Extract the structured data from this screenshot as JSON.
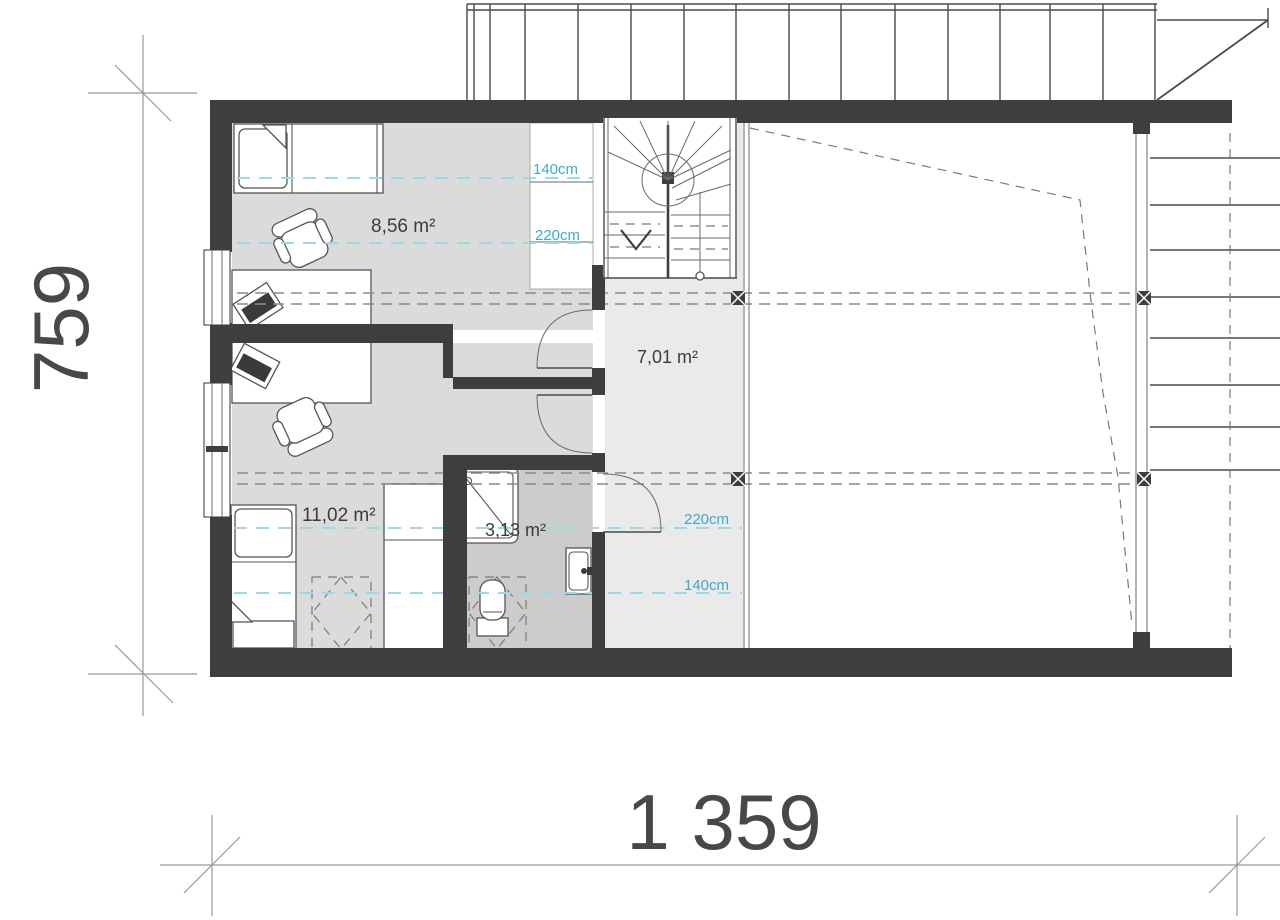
{
  "plan": {
    "title": "attic floor plan",
    "dimensions": {
      "width_label": "1 359",
      "height_label": "759"
    },
    "rooms": {
      "top_bedroom": {
        "area_label": "8,56 m²"
      },
      "hall": {
        "area_label": "7,01 m²"
      },
      "bottom_bedroom": {
        "area_label": "11,02 m²"
      },
      "bathroom": {
        "area_label": "3,13 m²"
      }
    },
    "height_labels": {
      "top_140": "140cm",
      "top_220": "220cm",
      "bottom_220": "220cm",
      "bottom_140": "140cm"
    },
    "colors": {
      "wall": "#3e3e3e",
      "room_floor": "#dbdbdb",
      "hall_floor": "#eaeaea",
      "bathroom_floor": "#cccccc",
      "height_line": "#9ad9ec",
      "height_label": "#41a9cc",
      "roof_dash": "#8a8a8a",
      "dimension_text": "#484848"
    }
  }
}
